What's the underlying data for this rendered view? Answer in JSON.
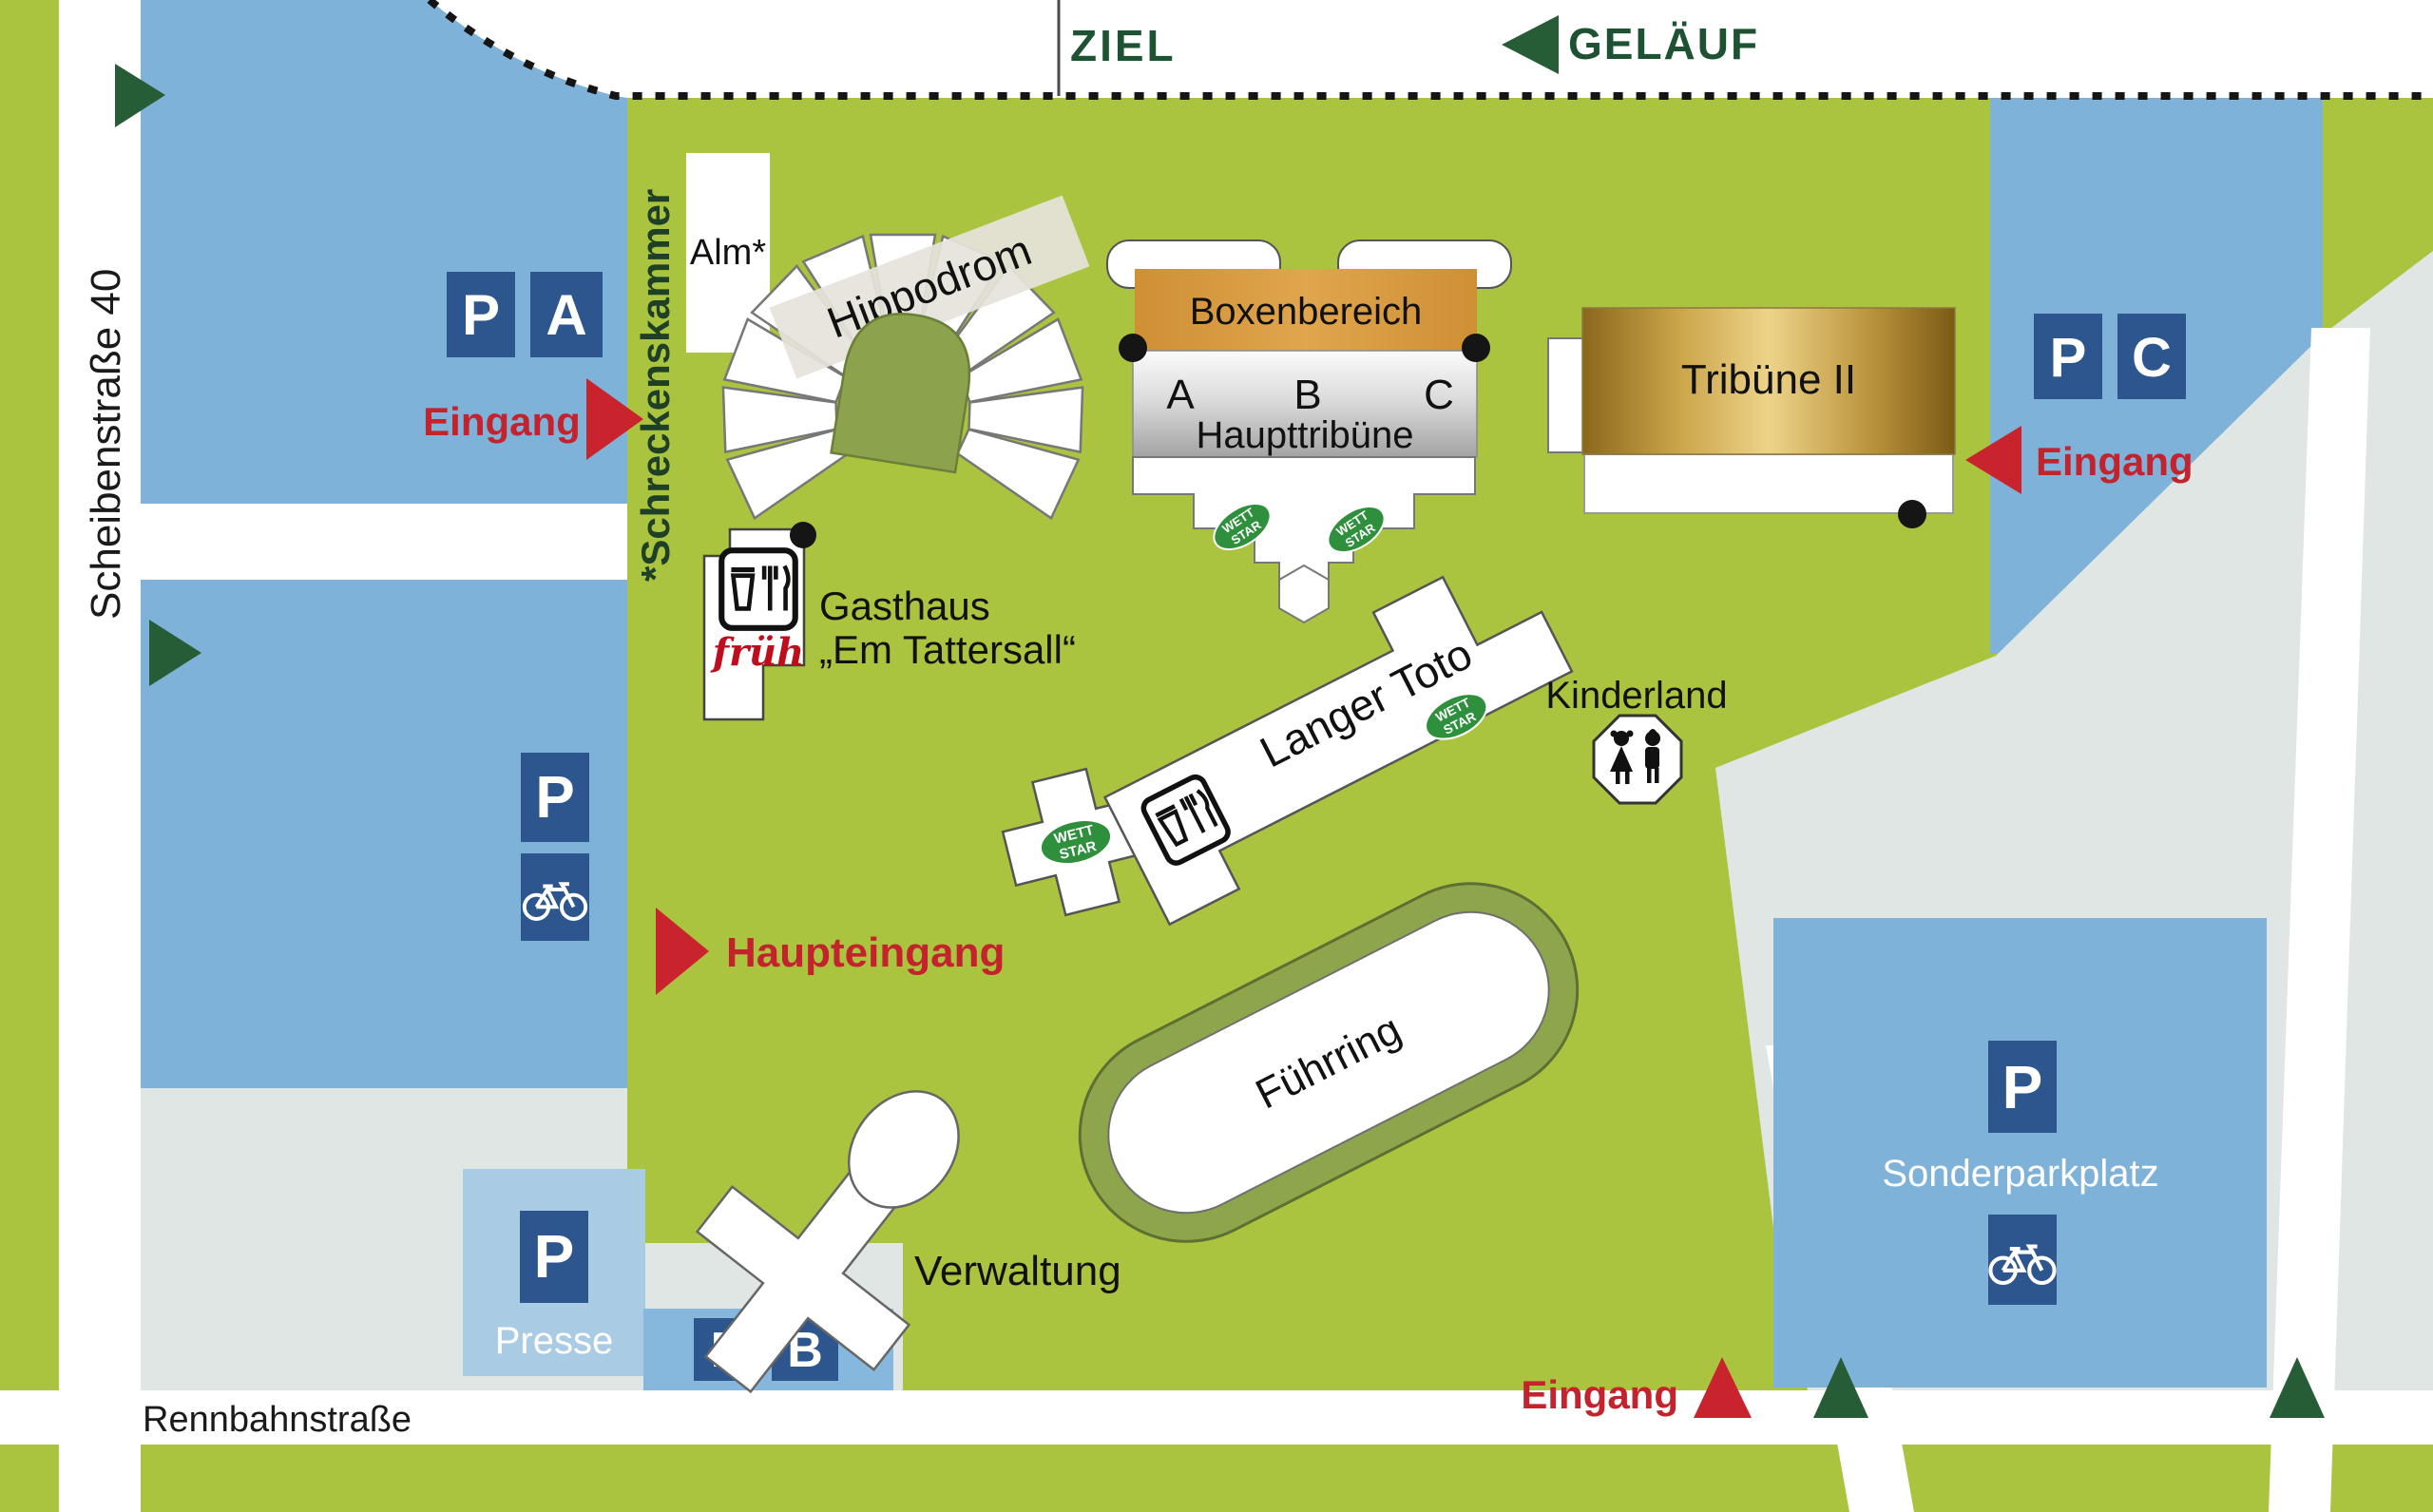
{
  "track": {
    "ziel": "ZIEL",
    "gelaeuf": "GELÄUF"
  },
  "streets": {
    "scheibenstrasse": "Scheibenstraße 40",
    "rennbahnstrasse": "Rennbahnstraße",
    "schreckenskammer": "*Schreckenskammer"
  },
  "entrances": {
    "north_label": "Eingang",
    "east_label": "Eingang",
    "south_label": "Eingang",
    "main_label": "Haupteingang"
  },
  "parking": {
    "p_a": {
      "p": "P",
      "zone": "A"
    },
    "p_b": {
      "p": "P",
      "zone": "B"
    },
    "p_c": {
      "p": "P",
      "zone": "C"
    },
    "p_bike": {
      "p": "P"
    },
    "p_presse": {
      "p": "P",
      "label": "Presse"
    },
    "sonderparkplatz": {
      "p": "P",
      "label": "Sonderparkplatz"
    }
  },
  "buildings": {
    "alm": "Alm*",
    "hippodrom": "Hippodrom",
    "boxenbereich": "Boxenbereich",
    "haupttribuene": {
      "label": "Haupttribüne",
      "sections": [
        "A",
        "B",
        "C"
      ]
    },
    "tribuene2": "Tribüne II",
    "gasthaus": {
      "line1": "Gasthaus",
      "line2": "„Em Tattersall“",
      "brand": "früh"
    },
    "langer_toto": "Langer Toto",
    "kinderland": "Kinderland",
    "fuehrring": "Führring",
    "verwaltung": "Verwaltung"
  },
  "wettstar": {
    "line1": "WETT",
    "line2": "STAR"
  },
  "colors": {
    "field_green": "#abc43f",
    "olive": "#8ea64b",
    "parking_blue": "#7fb2d8",
    "parking_blue_light": "#a9cbe3",
    "sign_blue": "#2d568f",
    "accent_red": "#c4232e",
    "dark_green_arrow": "#265c36",
    "track_label_green": "#1d5232",
    "gray_area": "#dfe6e3",
    "boxen_orange": "#d99b41",
    "wett_green": "#2e8f3d"
  }
}
